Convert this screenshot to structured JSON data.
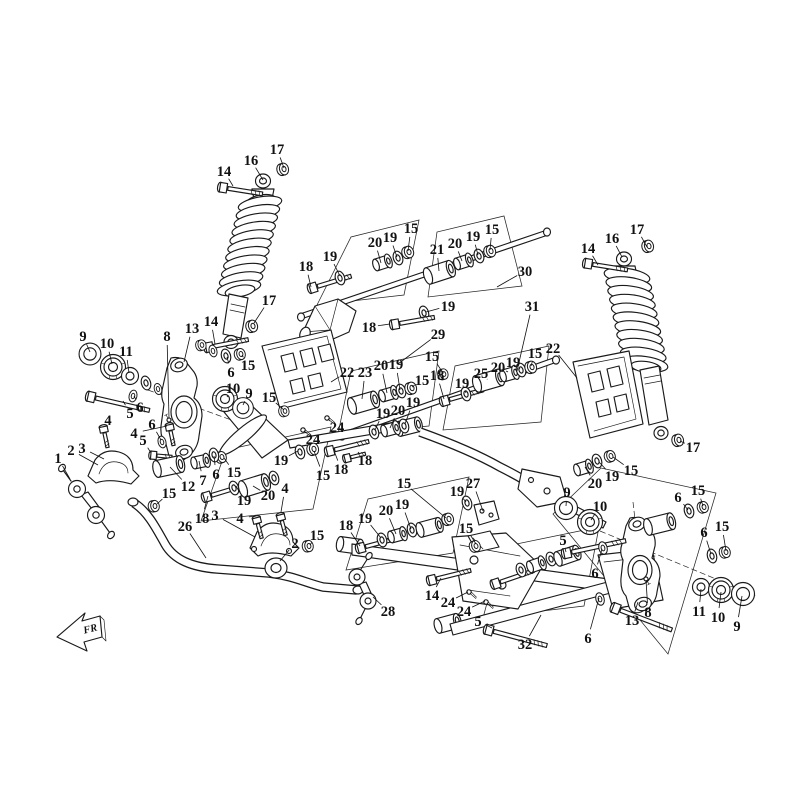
{
  "diagram": {
    "type": "exploded-parts-diagram",
    "subject": "rear suspension assembly",
    "colors": {
      "background": "#ffffff",
      "line": "#1a1a1a",
      "label": "#111111"
    }
  },
  "direction_indicator": {
    "label": "FR"
  },
  "callouts": [
    [
      "17",
      277,
      149,
      284,
      168
    ],
    [
      "16",
      251,
      160,
      263,
      180
    ],
    [
      "14",
      224,
      171,
      233,
      186
    ],
    [
      "18",
      306,
      266,
      311,
      287
    ],
    [
      "19",
      330,
      256,
      340,
      276
    ],
    [
      "17",
      269,
      300,
      254,
      323
    ],
    [
      "14",
      211,
      321,
      215,
      344
    ],
    [
      "13",
      192,
      328,
      184,
      362
    ],
    [
      "8",
      167,
      336,
      169,
      418
    ],
    [
      "9",
      83,
      336,
      90,
      352
    ],
    [
      "10",
      107,
      343,
      112,
      364
    ],
    [
      "11",
      126,
      351,
      129,
      373
    ],
    [
      "15",
      248,
      365,
      242,
      355
    ],
    [
      "6",
      231,
      372,
      227,
      357
    ],
    [
      "10",
      233,
      388,
      227,
      397
    ],
    [
      "9",
      249,
      393,
      243,
      405
    ],
    [
      "5",
      130,
      413,
      123,
      401
    ],
    [
      "6",
      140,
      407,
      134,
      396
    ],
    [
      "4",
      108,
      420,
      104,
      428
    ],
    [
      "4",
      134,
      433,
      167,
      426
    ],
    [
      "5",
      143,
      440,
      151,
      453
    ],
    [
      "6",
      152,
      424,
      161,
      440
    ],
    [
      "2",
      71,
      450,
      98,
      465
    ],
    [
      "3",
      82,
      448,
      104,
      459
    ],
    [
      "1",
      58,
      458,
      70,
      479
    ],
    [
      "20",
      375,
      242,
      381,
      263
    ],
    [
      "19",
      390,
      237,
      397,
      257
    ],
    [
      "15",
      411,
      228,
      408,
      251
    ],
    [
      "21",
      437,
      249,
      439,
      271
    ],
    [
      "20",
      455,
      243,
      462,
      261
    ],
    [
      "19",
      473,
      236,
      478,
      255
    ],
    [
      "15",
      492,
      229,
      490,
      250
    ],
    [
      "30",
      525,
      271,
      497,
      287
    ],
    [
      "19",
      448,
      306,
      426,
      312
    ],
    [
      "18",
      369,
      327,
      390,
      324
    ],
    [
      "29",
      438,
      334,
      398,
      364
    ],
    [
      "31",
      532,
      306,
      517,
      371
    ],
    [
      "14",
      588,
      248,
      598,
      265
    ],
    [
      "16",
      612,
      238,
      622,
      257
    ],
    [
      "17",
      637,
      229,
      647,
      247
    ],
    [
      "17",
      693,
      447,
      680,
      441
    ],
    [
      "15",
      631,
      470,
      613,
      457
    ],
    [
      "19",
      612,
      476,
      599,
      462
    ],
    [
      "20",
      595,
      483,
      585,
      467
    ],
    [
      "22",
      347,
      372,
      331,
      382
    ],
    [
      "23",
      365,
      372,
      362,
      399
    ],
    [
      "20",
      381,
      365,
      387,
      393
    ],
    [
      "19",
      396,
      364,
      400,
      390
    ],
    [
      "15",
      422,
      380,
      412,
      387
    ],
    [
      "18",
      437,
      375,
      444,
      399
    ],
    [
      "19",
      462,
      383,
      466,
      393
    ],
    [
      "25",
      481,
      373,
      487,
      379
    ],
    [
      "20",
      498,
      367,
      508,
      372
    ],
    [
      "19",
      513,
      362,
      520,
      369
    ],
    [
      "15",
      535,
      353,
      531,
      366
    ],
    [
      "22",
      553,
      348,
      577,
      378
    ],
    [
      "15",
      432,
      356,
      443,
      373
    ],
    [
      "19",
      281,
      460,
      298,
      451
    ],
    [
      "15",
      323,
      475,
      314,
      451
    ],
    [
      "18",
      341,
      469,
      333,
      448
    ],
    [
      "18",
      365,
      460,
      358,
      452
    ],
    [
      "24",
      337,
      427,
      328,
      419
    ],
    [
      "24",
      313,
      439,
      304,
      431
    ],
    [
      "19",
      383,
      413,
      375,
      430
    ],
    [
      "20",
      398,
      410,
      390,
      428
    ],
    [
      "19",
      413,
      402,
      405,
      424
    ],
    [
      "12",
      188,
      486,
      170,
      467
    ],
    [
      "7",
      203,
      480,
      199,
      461
    ],
    [
      "6",
      216,
      474,
      214,
      456
    ],
    [
      "15",
      169,
      493,
      157,
      504
    ],
    [
      "15",
      234,
      472,
      224,
      458
    ],
    [
      "19",
      244,
      500,
      236,
      486
    ],
    [
      "20",
      268,
      495,
      253,
      486
    ],
    [
      "4",
      285,
      488,
      281,
      512
    ],
    [
      "4",
      240,
      518,
      256,
      516
    ],
    [
      "3",
      215,
      515,
      255,
      537
    ],
    [
      "18",
      202,
      518,
      208,
      496
    ],
    [
      "26",
      185,
      526,
      206,
      558
    ],
    [
      "2",
      295,
      543,
      280,
      561
    ],
    [
      "15",
      317,
      535,
      310,
      545
    ],
    [
      "18",
      346,
      525,
      360,
      546
    ],
    [
      "19",
      365,
      518,
      381,
      538
    ],
    [
      "20",
      386,
      510,
      396,
      534
    ],
    [
      "19",
      402,
      504,
      411,
      529
    ],
    [
      "15",
      404,
      483,
      446,
      518
    ],
    [
      "19",
      457,
      491,
      466,
      502
    ],
    [
      "27",
      473,
      483,
      483,
      511
    ],
    [
      "14",
      432,
      595,
      441,
      578
    ],
    [
      "24",
      448,
      602,
      468,
      592
    ],
    [
      "24",
      464,
      611,
      485,
      601
    ],
    [
      "5",
      478,
      621,
      492,
      628
    ],
    [
      "32",
      525,
      644,
      541,
      615
    ],
    [
      "28",
      388,
      611,
      373,
      597
    ],
    [
      "15",
      466,
      528,
      476,
      544
    ],
    [
      "9",
      567,
      492,
      566,
      506
    ],
    [
      "10",
      600,
      506,
      591,
      520
    ],
    [
      "5",
      563,
      540,
      566,
      552
    ],
    [
      "6",
      595,
      573,
      602,
      549
    ],
    [
      "6",
      588,
      638,
      599,
      598
    ],
    [
      "6",
      678,
      497,
      688,
      510
    ],
    [
      "15",
      698,
      490,
      703,
      506
    ],
    [
      "6",
      704,
      532,
      711,
      554
    ],
    [
      "15",
      722,
      526,
      726,
      551
    ],
    [
      "11",
      699,
      611,
      701,
      589
    ],
    [
      "10",
      718,
      617,
      721,
      592
    ],
    [
      "9",
      737,
      626,
      742,
      596
    ],
    [
      "13",
      632,
      620,
      638,
      602
    ],
    [
      "8",
      648,
      612,
      646,
      580
    ],
    [
      "15",
      269,
      397,
      284,
      410
    ]
  ]
}
